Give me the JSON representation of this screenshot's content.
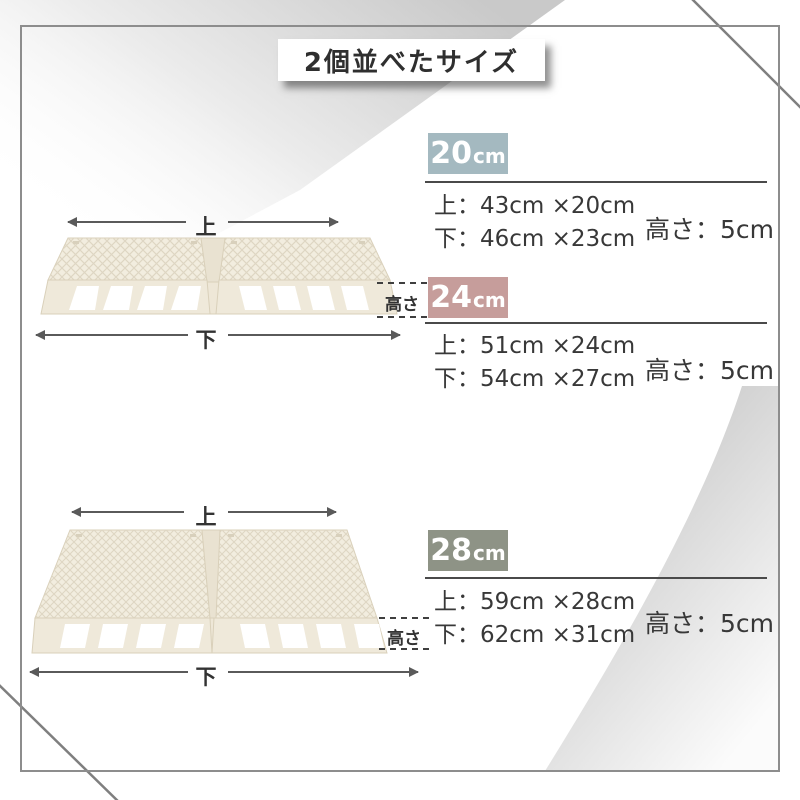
{
  "title": "2個並べたサイズ",
  "diagram_labels": {
    "top": "上",
    "bottom": "下",
    "height": "高さ"
  },
  "sections": [
    {
      "size": "20",
      "unit": "cm",
      "color": "#a4b9c0",
      "top_text": "上：43cm ×20cm",
      "bottom_text": "下：46cm ×23cm",
      "height_text": "高さ：5cm"
    },
    {
      "size": "24",
      "unit": "cm",
      "color": "#c69d9b",
      "top_text": "上：51cm ×24cm",
      "bottom_text": "下：54cm ×27cm",
      "height_text": "高さ：5cm"
    },
    {
      "size": "28",
      "unit": "cm",
      "color": "#8e9386",
      "top_text": "上：59cm ×28cm",
      "bottom_text": "下：62cm ×31cm",
      "height_text": "高さ：5cm"
    }
  ]
}
